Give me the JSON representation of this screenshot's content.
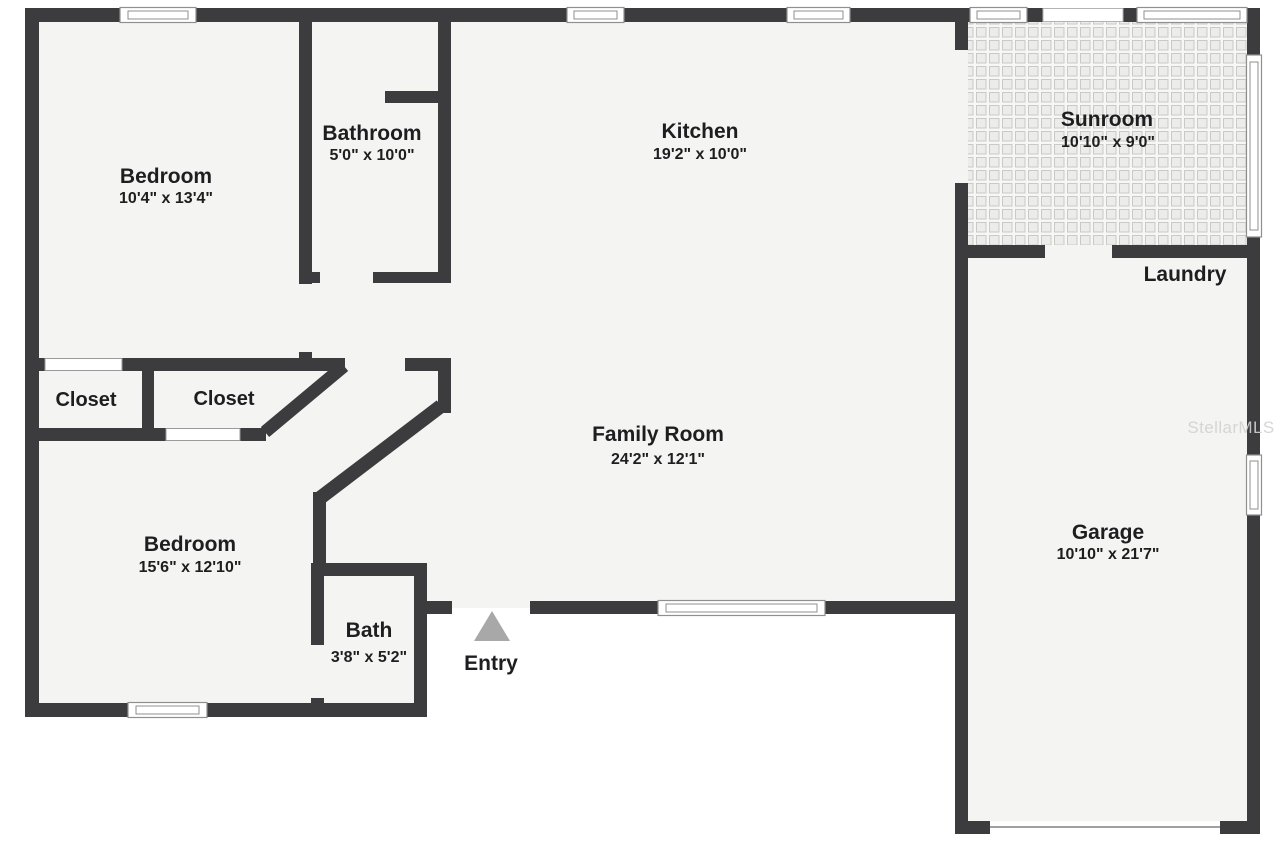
{
  "plan": {
    "watermark": "StellarMLS",
    "rooms": {
      "bedroom_top": {
        "label": "Bedroom",
        "dims": "10'4\" x 13'4\""
      },
      "bathroom": {
        "label": "Bathroom",
        "dims": "5'0\" x 10'0\""
      },
      "kitchen": {
        "label": "Kitchen",
        "dims": "19'2\" x 10'0\""
      },
      "sunroom": {
        "label": "Sunroom",
        "dims": "10'10\" x 9'0\""
      },
      "laundry": {
        "label": "Laundry"
      },
      "closet_left": {
        "label": "Closet"
      },
      "closet_right": {
        "label": "Closet"
      },
      "family_room": {
        "label": "Family Room",
        "dims": "24'2\" x 12'1\""
      },
      "bedroom_bottom": {
        "label": "Bedroom",
        "dims": "15'6\" x 12'10\""
      },
      "bath": {
        "label": "Bath",
        "dims": "3'8\" x 5'2\""
      },
      "entry": {
        "label": "Entry"
      },
      "garage": {
        "label": "Garage",
        "dims": "10'10\" x 21'7\""
      }
    },
    "colors": {
      "wall": "#3c3c3e",
      "floor": "#f4f4f3",
      "tile_line": "#c9c9c8",
      "window_frame": "#8f8f8f",
      "entry_marker": "#a8a8a8",
      "text": "#1e1e20",
      "watermark": "#d2d2d2"
    }
  }
}
